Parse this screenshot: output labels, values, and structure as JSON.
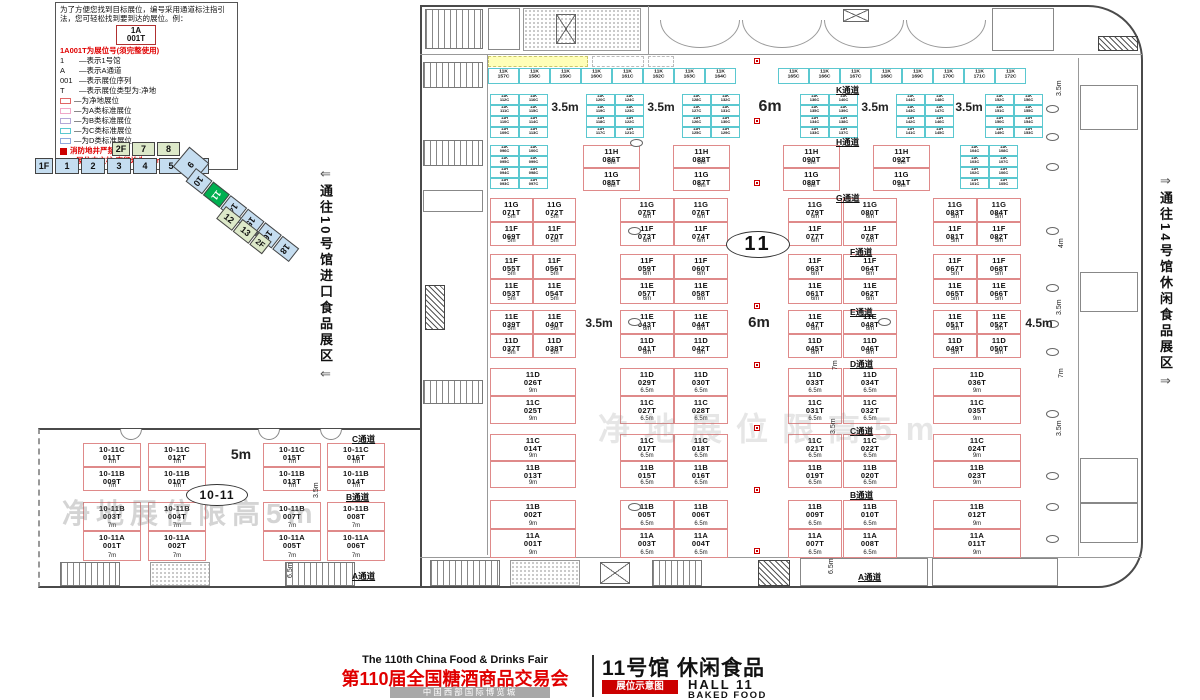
{
  "legend": {
    "intro": "为了方便您找到目标展位，编号采用通道标注指引法，您可轻松找到要到达的展位。例：",
    "example_code_line1": "1A",
    "example_code_line2": "001T",
    "title_note": "1A001T为展位号(须完整使用)",
    "items": [
      {
        "key": "1",
        "desc": "—表示1号馆"
      },
      {
        "key": "A",
        "desc": "—表示A通道"
      },
      {
        "key": "001",
        "desc": "—表示展位序列"
      },
      {
        "key": "T",
        "desc": "—表示展位类型为:净地"
      }
    ],
    "swatches": [
      {
        "color": "#e06666",
        "label": "—为净地展位"
      },
      {
        "color": "#f0a8c8",
        "label": "—为A类标准展位"
      },
      {
        "color": "#b4a7d6",
        "label": "—为B类标准展位"
      },
      {
        "color": "#5bc8d0",
        "label": "—为C类标准展位"
      },
      {
        "color": "#8faadc",
        "label": "—为D类标准展位"
      }
    ],
    "fire_note": "消防地井严禁遮挡",
    "pillar_note": "展位内立柱 直径均为1.5m"
  },
  "minimap": {
    "floor2_label": "2F",
    "floor2_halls": [
      "7",
      "8"
    ],
    "floor1_label": "1F",
    "floor1_halls": [
      "1",
      "2",
      "3",
      "4",
      "5",
      "6"
    ],
    "diamond_hall": "9",
    "diag_halls": [
      "10",
      "11",
      "14",
      "15",
      "16",
      "18"
    ],
    "active_hall": "11",
    "side_halls": [
      "12",
      "13"
    ],
    "side_tag": "2F"
  },
  "side_labels": {
    "left": "通往10号馆进口食品展区",
    "right": "通往14号馆休闲食品展区",
    "left_arrow": "⇐",
    "right_arrow": "⇒"
  },
  "ovals": {
    "hall": "11",
    "annex": "10-11"
  },
  "watermark": "净地展位限高5m",
  "aisle_labels": [
    [
      "K通道",
      836,
      84
    ],
    [
      "H通道",
      836,
      136
    ],
    [
      "G通道",
      836,
      192
    ],
    [
      "F通道",
      850,
      246
    ],
    [
      "E通道",
      850,
      306
    ],
    [
      "D通道",
      850,
      358
    ],
    [
      "C通道",
      850,
      425
    ],
    [
      "B通道",
      850,
      489
    ],
    [
      "A通道",
      858,
      571
    ],
    [
      "C通道",
      352,
      433
    ],
    [
      "B通道",
      346,
      491
    ],
    [
      "A通道",
      352,
      570
    ]
  ],
  "dim_labels": {
    "flat": [
      [
        "3.5m",
        548,
        100,
        12
      ],
      [
        "3.5m",
        644,
        100,
        12
      ],
      [
        "6m",
        753,
        98,
        16
      ],
      [
        "3.5m",
        858,
        100,
        12
      ],
      [
        "3.5m",
        952,
        100,
        12
      ],
      [
        "3.5m",
        582,
        316,
        12
      ],
      [
        "6m",
        742,
        314,
        15
      ],
      [
        "4.5m",
        1022,
        316,
        12
      ],
      [
        "5m",
        224,
        446,
        14
      ]
    ],
    "rotated": [
      [
        "3.5m",
        1056,
        96
      ],
      [
        "4m",
        1058,
        248
      ],
      [
        "3.5m",
        1056,
        315
      ],
      [
        "7m",
        1058,
        378
      ],
      [
        "3.5m",
        1056,
        436
      ],
      [
        "7m",
        832,
        370
      ],
      [
        "3.5m",
        830,
        434
      ],
      [
        "6.5m",
        828,
        574
      ],
      [
        "3.5m",
        313,
        498
      ],
      [
        "6.5m",
        287,
        578
      ]
    ]
  },
  "booths": {
    "cyan_strip": {
      "y": 68,
      "groups": [
        {
          "x": 488,
          "start": 157
        },
        {
          "x": 778,
          "start": 165
        }
      ]
    },
    "cyan_blocks": [
      {
        "x": 490,
        "y": 94,
        "start": 109
      },
      {
        "x": 586,
        "y": 94,
        "start": 117
      },
      {
        "x": 682,
        "y": 94,
        "start": 125
      },
      {
        "x": 800,
        "y": 94,
        "start": 133
      },
      {
        "x": 896,
        "y": 94,
        "start": 141
      },
      {
        "x": 985,
        "y": 94,
        "start": 149
      },
      {
        "x": 490,
        "y": 145,
        "start": 93
      },
      {
        "x": 960,
        "y": 145,
        "start": 101
      }
    ],
    "hg": {
      "dim": "6m",
      "items": [
        {
          "x": 583,
          "t": "11H 086T",
          "b": "11G 085T"
        },
        {
          "x": 673,
          "t": "11H 088T",
          "b": "11G 087T"
        },
        {
          "x": 783,
          "t": "11H 090T",
          "b": "11G 089T"
        },
        {
          "x": 873,
          "t": "11H 092T",
          "b": "11G 091T"
        }
      ]
    },
    "grid": {
      "cols8": [
        [
          490,
          43
        ],
        [
          533,
          43
        ],
        [
          620,
          54
        ],
        [
          674,
          54
        ],
        [
          788,
          54
        ],
        [
          843,
          54
        ],
        [
          933,
          44
        ],
        [
          977,
          44
        ]
      ],
      "cols6": [
        [
          490,
          86
        ],
        [
          620,
          54
        ],
        [
          674,
          54
        ],
        [
          788,
          54
        ],
        [
          843,
          54
        ],
        [
          933,
          88
        ]
      ],
      "dims8": [
        "5m",
        "5m",
        "6m",
        "6m",
        "6m",
        "6m",
        "5m",
        "5m"
      ],
      "dims6": [
        "9m",
        "6.5m",
        "6.5m",
        "6.5m",
        "6.5m",
        "9m"
      ],
      "bands": [
        {
          "y": 198,
          "rh": 24,
          "cols": 8,
          "top": [
            "11G 071T",
            "11G 072T",
            "11G 075T",
            "11G 076T",
            "11G 079T",
            "11G 080T",
            "11G 083T",
            "11G 084T"
          ],
          "bottom": [
            "11F 069T",
            "11F 070T",
            "11F 073T",
            "11F 074T",
            "11F 077T",
            "11F 078T",
            "11F 081T",
            "11F 082T"
          ]
        },
        {
          "y": 254,
          "rh": 25,
          "cols": 8,
          "top": [
            "11F 055T",
            "11F 056T",
            "11F 059T",
            "11F 060T",
            "11F 063T",
            "11F 064T",
            "11F 067T",
            "11F 068T"
          ],
          "bottom": [
            "11E 053T",
            "11E 054T",
            "11E 057T",
            "11E 058T",
            "11E 061T",
            "11E 062T",
            "11E 065T",
            "11E 066T"
          ]
        },
        {
          "y": 310,
          "rh": 24,
          "cols": 8,
          "top": [
            "11E 039T",
            "11E 040T",
            "11E 043T",
            "11E 044T",
            "11E 047T",
            "11E 048T",
            "11E 051T",
            "11E 052T"
          ],
          "bottom": [
            "11D 037T",
            "11D 038T",
            "11D 041T",
            "11D 042T",
            "11D 045T",
            "11D 046T",
            "11D 049T",
            "11D 050T"
          ]
        },
        {
          "y": 368,
          "rh": 28,
          "cols": 6,
          "top": [
            "11D 026T",
            "11D 029T",
            "11D 030T",
            "11D 033T",
            "11D 034T",
            "11D 036T"
          ],
          "bottom": [
            "11C 025T",
            "11C 027T",
            "11C 028T",
            "11C 031T",
            "11C 032T",
            "11C 035T"
          ]
        },
        {
          "y": 434,
          "rh": 27,
          "cols": 6,
          "top": [
            "11C 014T",
            "11C 017T",
            "11C 018T",
            "11C 021T",
            "11C 022T",
            "11C 024T"
          ],
          "bottom": [
            "11B 013T",
            "11B 015T",
            "11B 016T",
            "11B 019T",
            "11B 020T",
            "11B 023T"
          ]
        },
        {
          "y": 500,
          "rh": 29,
          "cols": 6,
          "top": [
            "11B 002T",
            "11B 005T",
            "11B 006T",
            "11B 009T",
            "11B 010T",
            "11B 012T"
          ],
          "bottom": [
            "11A 001T",
            "11A 003T",
            "11A 004T",
            "11A 007T",
            "11A 008T",
            "11A 011T"
          ]
        }
      ]
    },
    "annex": {
      "xs": [
        83,
        148,
        263,
        327
      ],
      "rows": [
        {
          "y": 443,
          "h": 24,
          "dim": "7m",
          "ids": [
            "10-11C 011T",
            "10-11C 012T",
            "10-11C 015T",
            "10-11C 016T"
          ]
        },
        {
          "y": 467,
          "h": 24,
          "dim": "7m",
          "ids": [
            "10-11B 009T",
            "10-11B 010T",
            "10-11B 013T",
            "10-11B 014T"
          ]
        },
        {
          "y": 502,
          "h": 29,
          "dim": "7m",
          "ids": [
            "10-11B 003T",
            "10-11B 004T",
            "10-11B 007T",
            "10-11B 008T"
          ]
        },
        {
          "y": 531,
          "h": 30,
          "dim": "7m",
          "ids": [
            "10-11A 001T",
            "10-11A 002T",
            "10-11A 005T",
            "10-11A 006T"
          ]
        }
      ]
    }
  },
  "pillars": [
    [
      628,
      227
    ],
    [
      628,
      318
    ],
    [
      878,
      318
    ],
    [
      628,
      503
    ],
    [
      630,
      139
    ],
    [
      1046,
      105
    ],
    [
      1046,
      133
    ],
    [
      1046,
      163
    ],
    [
      1046,
      227
    ],
    [
      1046,
      284
    ],
    [
      1046,
      320
    ],
    [
      1046,
      348
    ],
    [
      1046,
      410
    ],
    [
      1046,
      472
    ],
    [
      1046,
      503
    ],
    [
      1046,
      535
    ]
  ],
  "fire_markers": [
    [
      754,
      58
    ],
    [
      754,
      118
    ],
    [
      754,
      180
    ],
    [
      754,
      238
    ],
    [
      754,
      303
    ],
    [
      754,
      362
    ],
    [
      754,
      425
    ],
    [
      754,
      487
    ],
    [
      754,
      548
    ]
  ],
  "footer": {
    "en_title": "The 110th China Food & Drinks Fair",
    "cn_title": "第110届全国糖酒商品交易会",
    "venue": "中国西部国际博览城",
    "hall_cn": "11号馆 休闲食品",
    "hall_en": "HALL 11",
    "hall_sub": "BAKED FOOD",
    "badge": "展位示意图"
  }
}
